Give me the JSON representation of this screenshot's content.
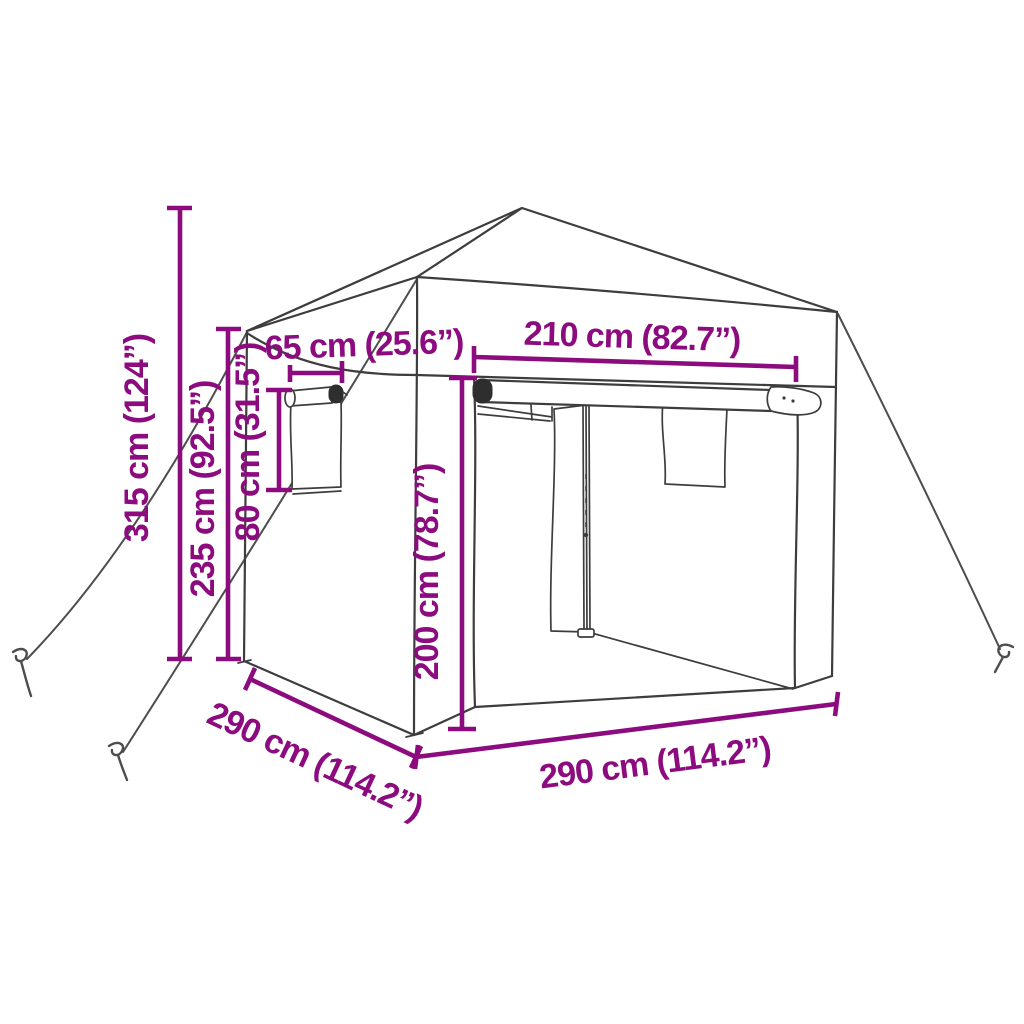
{
  "diagram": {
    "subject": "pop-up gazebo party tent with sidewalls, rolled-up door, side window, guy ropes and ground pegs",
    "colors": {
      "dimension": "#8C0B7E",
      "line_art": "#3d3d3d",
      "background": "#ffffff"
    },
    "dimensions": [
      {
        "id": "total-height",
        "label": "315 cm (124”)",
        "orientation": "vertical"
      },
      {
        "id": "eave-height",
        "label": "235 cm (92.5”)",
        "orientation": "vertical"
      },
      {
        "id": "window-height",
        "label": "80 cm (31.5”)",
        "orientation": "vertical"
      },
      {
        "id": "window-width",
        "label": "65 cm (25.6”)",
        "orientation": "horizontal"
      },
      {
        "id": "door-width",
        "label": "210 cm (82.7”)",
        "orientation": "horizontal"
      },
      {
        "id": "inner-height",
        "label": "200 cm (78.7”)",
        "orientation": "vertical"
      },
      {
        "id": "side-depth",
        "label": "290 cm (114.2”)",
        "orientation": "diagonal"
      },
      {
        "id": "front-width",
        "label": "290 cm (114.2”)",
        "orientation": "horizontal"
      }
    ]
  }
}
